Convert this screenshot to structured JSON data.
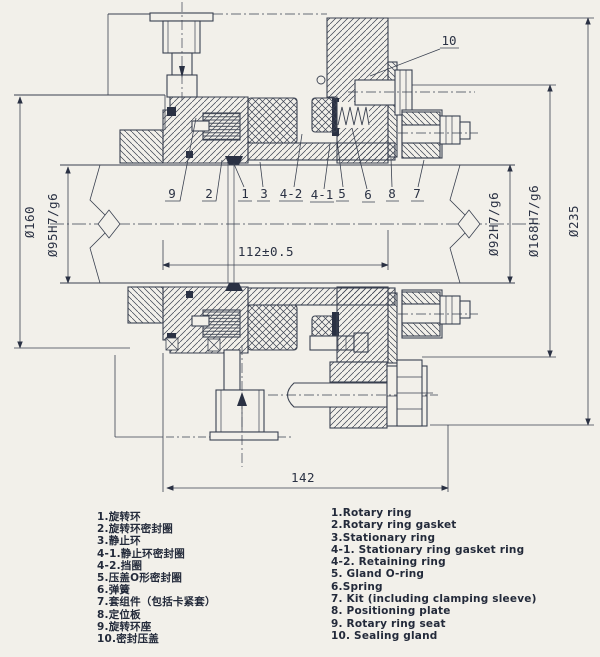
{
  "drawing": {
    "dims": {
      "d160": "Ø160",
      "d95": "Ø95H7/g6",
      "d112": "112±0.5",
      "d92": "Ø92H7/g6",
      "d168": "Ø168H7/g6",
      "d235": "Ø235",
      "l142": "142"
    },
    "callouts": {
      "c9": "9",
      "c2": "2",
      "c1": "1",
      "c3": "3",
      "c4_2": "4-2",
      "c4_1": "4-1",
      "c5": "5",
      "c6": "6",
      "c8": "8",
      "c7": "7",
      "c10": "10"
    }
  },
  "parts_list": {
    "cn": [
      "1.旋转环",
      "2.旋转环密封圈",
      "3.静止环",
      "4-1.静止环密封圈",
      "4-2.挡圈",
      "5.压盖O形密封圈",
      "6.弹簧",
      "7.套组件（包括卡紧套）",
      "8.定位板",
      "9.旋转环座",
      "10.密封压盖"
    ],
    "en": [
      "1.Rotary ring",
      "2.Rotary ring gasket",
      "3.Stationary ring",
      "4-1. Stationary ring gasket ring",
      "4-2. Retaining ring",
      "5. Gland O-ring",
      "6.Spring",
      "7. Kit (including clamping sleeve)",
      "8. Positioning plate",
      "9. Rotary ring seat",
      "10. Sealing gland"
    ]
  }
}
